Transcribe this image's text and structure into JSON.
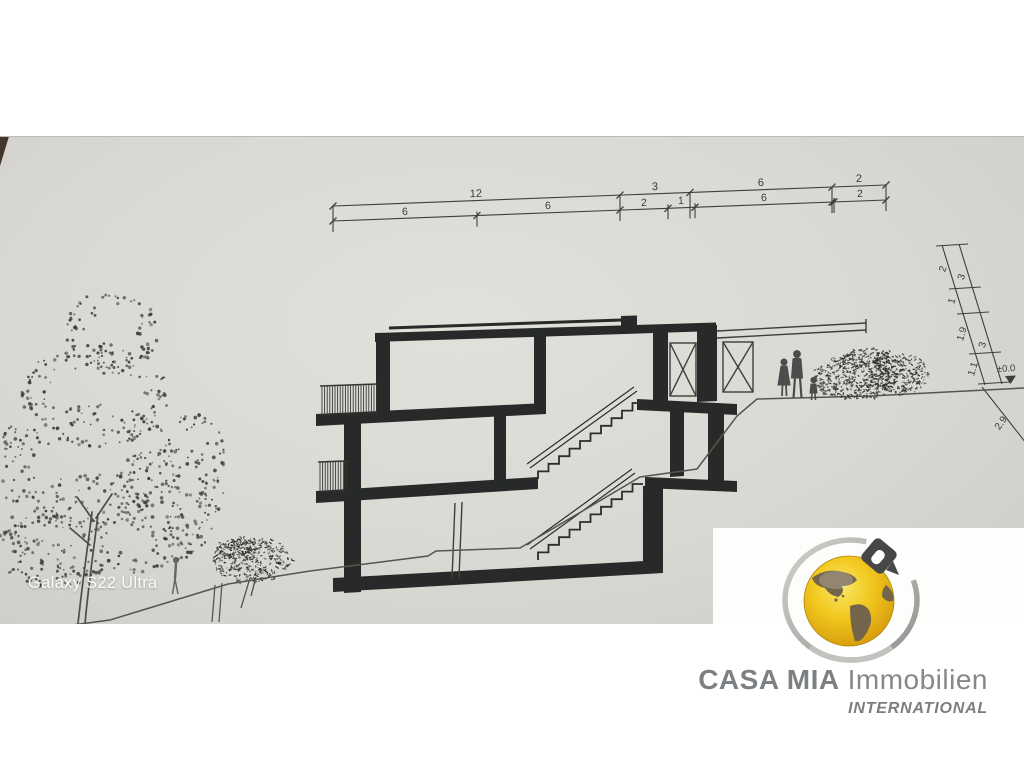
{
  "watermark": {
    "text": "Galaxy S22 Ultra"
  },
  "logo": {
    "brand_strong": "CASA MIA",
    "brand_light": "Immobilien",
    "tagline": "INTERNATIONAL",
    "globe_color": "#f2c71d",
    "ring_color": "#b5b3af",
    "house_color": "#47474a"
  },
  "dimensions": {
    "top_upper": [
      "12",
      "3",
      "6",
      "2"
    ],
    "top_lower": [
      "6",
      "6",
      "2",
      "1",
      "6",
      "2"
    ],
    "right_inner": [
      "2",
      "1",
      "1.9",
      "1.1"
    ],
    "right_outer": [
      "3",
      "3"
    ],
    "level_marker": "±0.0",
    "depth_below": "2.9"
  },
  "colors": {
    "ink": "#2b2e2c",
    "thin_line": "#4a4d4a",
    "paper": "#dad8d3"
  }
}
